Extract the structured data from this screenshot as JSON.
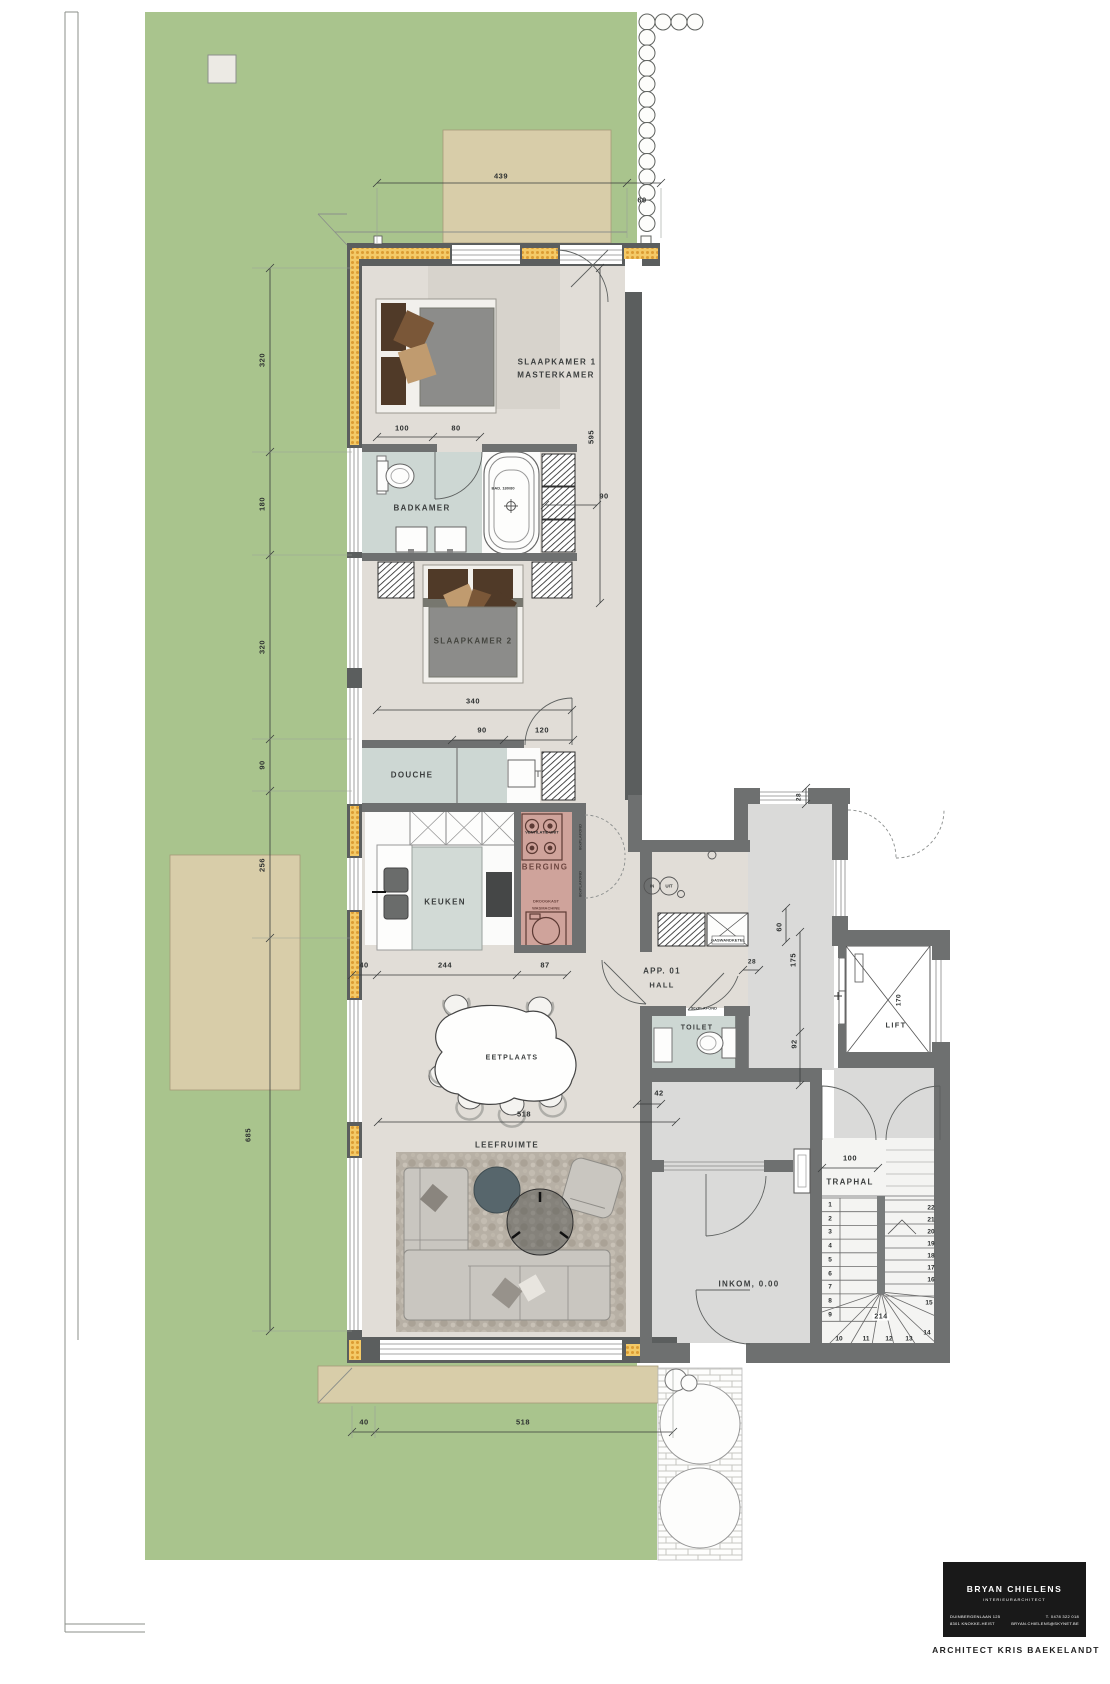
{
  "rooms": {
    "slaapkamer1_l1": "SLAAPKAMER 1",
    "slaapkamer1_l2": "MASTERKAMER",
    "badkamer": "BADKAMER",
    "slaapkamer2": "SLAAPKAMER 2",
    "douche": "DOUCHE",
    "berging": "BERGING",
    "keuken": "KEUKEN",
    "eetplaats": "EETPLAATS",
    "leefruimte": "LEEFRUIMTE",
    "toilet": "TOILET",
    "app_hall_l1": "APP. 01",
    "app_hall_l2": "HALL",
    "traphal": "TRAPHAL",
    "lift": "LIFT",
    "inkom": "INKOM, 0.00"
  },
  "fixtures": {
    "bad": "BAD. 180/80",
    "ventilatie_unit": "VENTILATIE UNIT",
    "droogkast": "DROOGKAST",
    "wasmachine": "WASMACHINE",
    "gaswandketel": "GASWANDKETEL",
    "plafond_90": "90xPLAFOND",
    "plafond_80": "80xPLAFOND",
    "in": "IN",
    "uit": "UIT"
  },
  "dims": {
    "top_439": "439",
    "top_60": "60",
    "left_320a": "320",
    "left_180": "180",
    "left_320b": "320",
    "left_90": "90",
    "left_256": "256",
    "left_685": "685",
    "sl1_100": "100",
    "sl1_80": "80",
    "sl1_595": "595",
    "bad_90": "90",
    "sl2_340": "340",
    "sl2_90": "90",
    "sl2_120": "120",
    "k_40": "40",
    "k_244": "244",
    "k_87": "87",
    "eet_518": "518",
    "eet_42": "42",
    "h_28a": "28",
    "h_60": "60",
    "h_175": "175",
    "h_28b": "28",
    "h_92": "92",
    "trap_100": "100",
    "trap_214": "214",
    "lift_170": "170",
    "b_40": "40",
    "b_518": "518"
  },
  "stairs": {
    "left": [
      "1",
      "2",
      "3",
      "4",
      "5",
      "6",
      "7",
      "8",
      "9"
    ],
    "bottom": [
      "10",
      "11",
      "12",
      "13"
    ],
    "right": [
      "22",
      "21",
      "20",
      "19",
      "18",
      "17",
      "16",
      "15",
      "14"
    ]
  },
  "title_block": {
    "name": "BRYAN CHIELENS",
    "role": "INTERIEURARCHITECT",
    "address1": "DUINBERGENLAAN 125",
    "address2": "8301 KNOKKE-HEIST",
    "phone": "T. 0478 322 018",
    "email": "BRYAN.CHIELENS@SKYNET.BE",
    "architect": "ARCHITECT KRIS BAEKELANDT"
  },
  "colors": {
    "garden": "#a9c48d",
    "terrace": "#d8cda9",
    "wall": "#5b5e5e",
    "insulation": "#f2c45f",
    "apartment_floor": "#e1ddd7",
    "common_floor": "#dadad9",
    "wet_room": "#cdd7d3",
    "berging": "#cfa39b"
  }
}
